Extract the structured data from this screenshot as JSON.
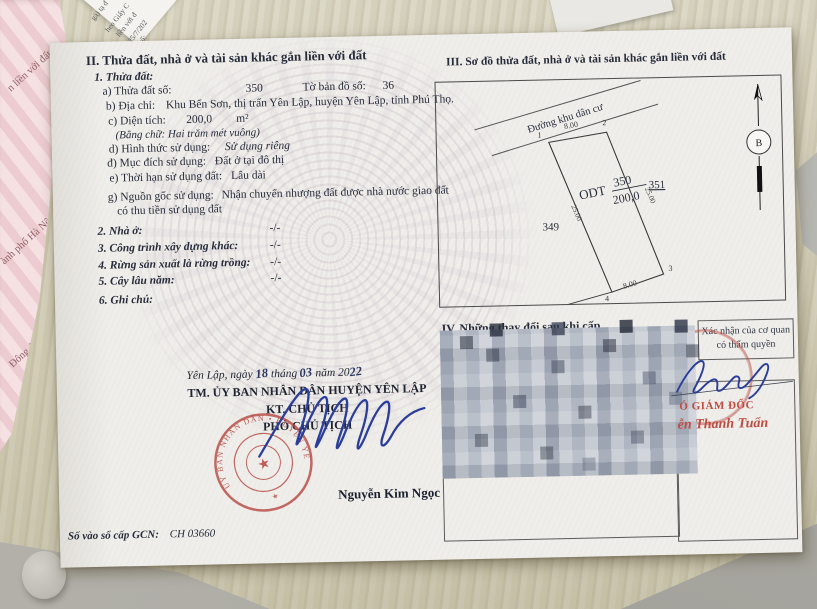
{
  "colors": {
    "stamp_red": "#b5423c",
    "ink_blue": "#2b3e9b",
    "paper_pink": "#eccfd3"
  },
  "background": {
    "pink_fragments": [
      "n liền với đất",
      "ành phố Hà Nội",
      "Đông Anh, thành ph"
    ],
    "corner_fragments": [
      "gà) tạ đ",
      "heo Giấy C",
      "liền với đ",
      "25/7/202",
      "số:"
    ]
  },
  "document": {
    "section_ii": {
      "title": "II. Thửa đất, nhà ở và tài sản khác gắn liền với đất",
      "parcel_heading": "1. Thửa đất:",
      "parcel_no_label": "a) Thửa đất số:",
      "parcel_no": "350",
      "map_sheet_label": "Tờ bản đồ số:",
      "map_sheet": "36",
      "address_label": "b) Địa chỉ:",
      "address": "Khu Bến Sơn, thị trấn Yên Lập, huyện Yên Lập, tỉnh Phú Thọ.",
      "area_label": "c) Diện tích:",
      "area": "200,0",
      "area_unit": "m²",
      "area_words": "(Bằng chữ: Hai trăm mét vuông)",
      "use_form_label": "d) Hình thức sử dụng:",
      "use_form": "Sử dụng riêng",
      "purpose_label": "đ) Mục đích sử dụng:",
      "purpose": "Đất ở tại đô thị",
      "term_label": "e) Thời hạn sử dụng đất:",
      "term": "Lâu dài",
      "origin_label": "g) Nguồn gốc sử dụng:",
      "origin_line1": "Nhận chuyển nhượng đất được nhà nước giao đất",
      "origin_line2": "có thu tiền sử dụng đất",
      "house_label": "2. Nhà ở:",
      "house_value": "-/-",
      "construction_label": "3. Công trình xây dựng khác:",
      "construction_value": "-/-",
      "forest_label": "4. Rừng sản xuất là rừng trồng:",
      "forest_value": "-/-",
      "perennial_label": "5. Cây lâu năm:",
      "perennial_value": "-/-",
      "notes_label": "6. Ghi chú:"
    },
    "section_iii": {
      "title": "III. Sơ đồ thửa đất, nhà ở và tài sản khác gắn liền với đất",
      "road_label": "Đường khu dân cư",
      "plot_use_code": "ODT",
      "plot_number": "350",
      "plot_area": "200,0",
      "adjacent_left": "349",
      "adjacent_right": "351",
      "dim_top": "8.00",
      "dim_bottom": "8.00",
      "dim_left": "25.00",
      "dim_right": "25.00",
      "corner_1": "1",
      "corner_2": "2",
      "corner_3": "3",
      "corner_4": "4",
      "north_label": "B"
    },
    "section_iv": {
      "title_visible": "IV. Những thay đổi sau khi cấp",
      "authority_box_line1": "Xác nhận của cơ quan",
      "authority_box_line2": "có thẩm quyền",
      "red_title_visible": "Ó GIÁM ĐỐC",
      "red_signer_visible": "ễn Thanh Tuấn"
    },
    "issuance": {
      "place_date_prefix": "Yên Lập, ngày",
      "day": "18",
      "month_label": "tháng",
      "month": "03",
      "year_label": "năm 20",
      "year": "22",
      "org": "TM. ỦY BAN NHÂN DÂN HUYỆN YÊN LẬP",
      "on_behalf": "KT. CHỦ TỊCH",
      "title": "PHÓ CHỦ TỊCH",
      "signer": "Nguyễn Kim Ngọc",
      "stamp_text": "ỦY BAN NHÂN DÂN • HUYỆN YÊN LẬP •",
      "registry_label": "Số vào sổ cấp GCN:",
      "registry_value": "CH 03660"
    }
  }
}
